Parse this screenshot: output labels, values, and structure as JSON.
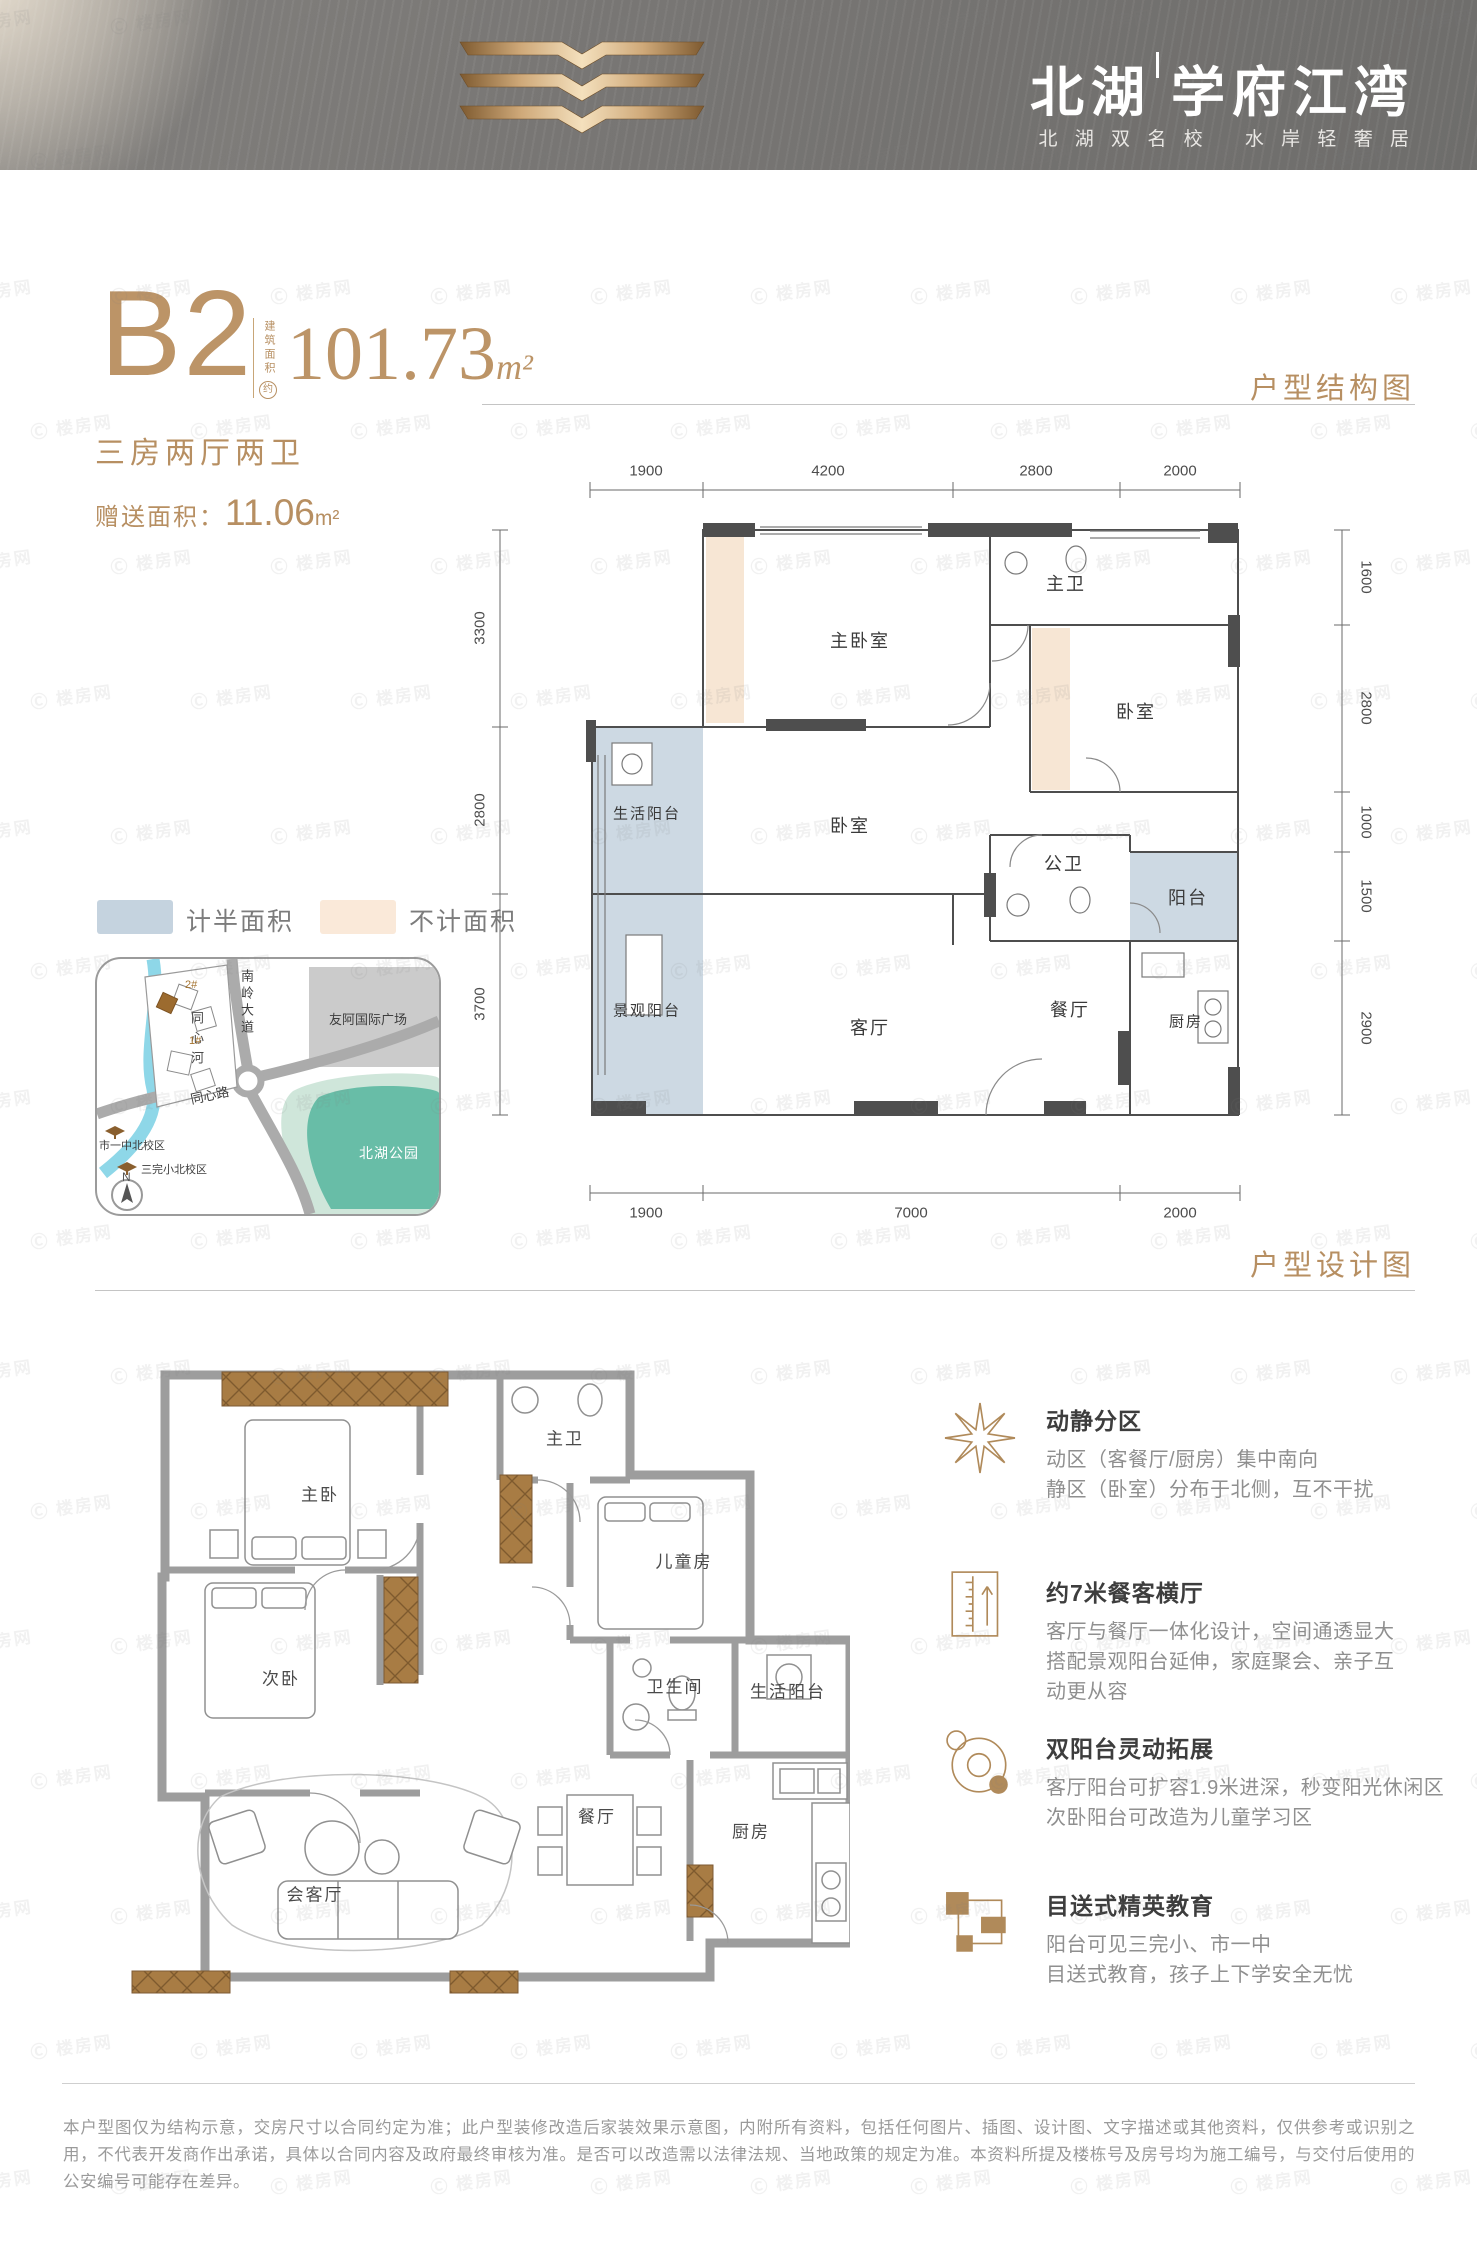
{
  "watermark": {
    "text": "Ⓒ 楼房网"
  },
  "header": {
    "title_a": "北湖",
    "title_b": "学府江湾",
    "subtitle": "北 湖 双 名 校　 水 岸 轻 奢 居",
    "logo": "open-book-logo"
  },
  "unit": {
    "name": "B2",
    "area_note_vertical": "建筑面积",
    "area_note_circle": "约",
    "area_value": "101.73",
    "area_unit": "m²",
    "layout": "三房两厅两卫",
    "bonus_label": "赠送面积：",
    "bonus_value": "11.06",
    "bonus_unit": "m²"
  },
  "section_labels": {
    "structure": "户型结构图",
    "design": "户型设计图"
  },
  "legend": [
    {
      "label": "计半面积",
      "color": "#c5d3df"
    },
    {
      "label": "不计面积",
      "color": "#fae9d9"
    }
  ],
  "map": {
    "river": "同心河",
    "road_vertical": "南岭大道",
    "road_diagonal": "同心路",
    "plaza": "友阿国际广场",
    "park": "北湖公园",
    "school_1": "市一中北校区",
    "school_2": "三完小北校区",
    "building_1": "1#",
    "building_2": "2#",
    "compass": "N"
  },
  "structure_plan": {
    "rooms": {
      "master_bedroom": "主卧室",
      "master_bath": "主卫",
      "bedroom_right": "卧室",
      "bedroom_center": "卧室",
      "public_bath": "公卫",
      "balcony": "阳台",
      "service_balcony": "生活阳台",
      "view_balcony": "景观阳台",
      "living": "客厅",
      "dining": "餐厅",
      "kitchen": "厨房"
    },
    "dims_top": [
      "1900",
      "4200",
      "2800",
      "2000"
    ],
    "dims_left": [
      "3300",
      "2800",
      "3700"
    ],
    "dims_right": [
      "1600",
      "2800",
      "1000",
      "1500",
      "2900"
    ],
    "dims_bottom": [
      "1900",
      "7000",
      "2000"
    ]
  },
  "design_plan": {
    "rooms": {
      "master": "主卧",
      "master_bath": "主卫",
      "second": "次卧",
      "kids": "儿童房",
      "bath": "卫生间",
      "service_balcony": "生活阳台",
      "dining": "餐厅",
      "kitchen": "厨房",
      "living": "会客厅"
    }
  },
  "features": [
    {
      "icon": "star-burst-icon",
      "title": "动静分区",
      "lines": [
        "动区（客餐厅/厨房）集中南向",
        "静区（卧室）分布于北侧，互不干扰"
      ]
    },
    {
      "icon": "ruler-icon",
      "title": "约7米餐客横厅",
      "lines": [
        "客厅与餐厅一体化设计，空间通透显大",
        "搭配景观阳台延伸，家庭聚会、亲子互",
        "动更从容"
      ]
    },
    {
      "icon": "orbit-icon",
      "title": "双阳台灵动拓展",
      "lines": [
        "客厅阳台可扩容1.9米进深，秒变阳光休闲区",
        "次卧阳台可改造为儿童学习区"
      ]
    },
    {
      "icon": "blocks-icon",
      "title": "目送式精英教育",
      "lines": [
        "阳台可见三完小、市一中",
        "目送式教育，孩子上下学安全无忧"
      ]
    }
  ],
  "disclaimer": "本户型图仅为结构示意，交房尺寸以合同约定为准；此户型装修改造后家装效果示意图，内附所有资料，包括任何图片、插图、设计图、文字描述或其他资料，仅供参考或识别之用，不代表开发商作出承诺，具体以合同内容及政府最终审核为准。是否可以改造需以法律法规、当地政策的规定为准。本资料所提及楼栋号及房号均为施工编号，与交付后使用的公安编号可能存在差异。"
}
